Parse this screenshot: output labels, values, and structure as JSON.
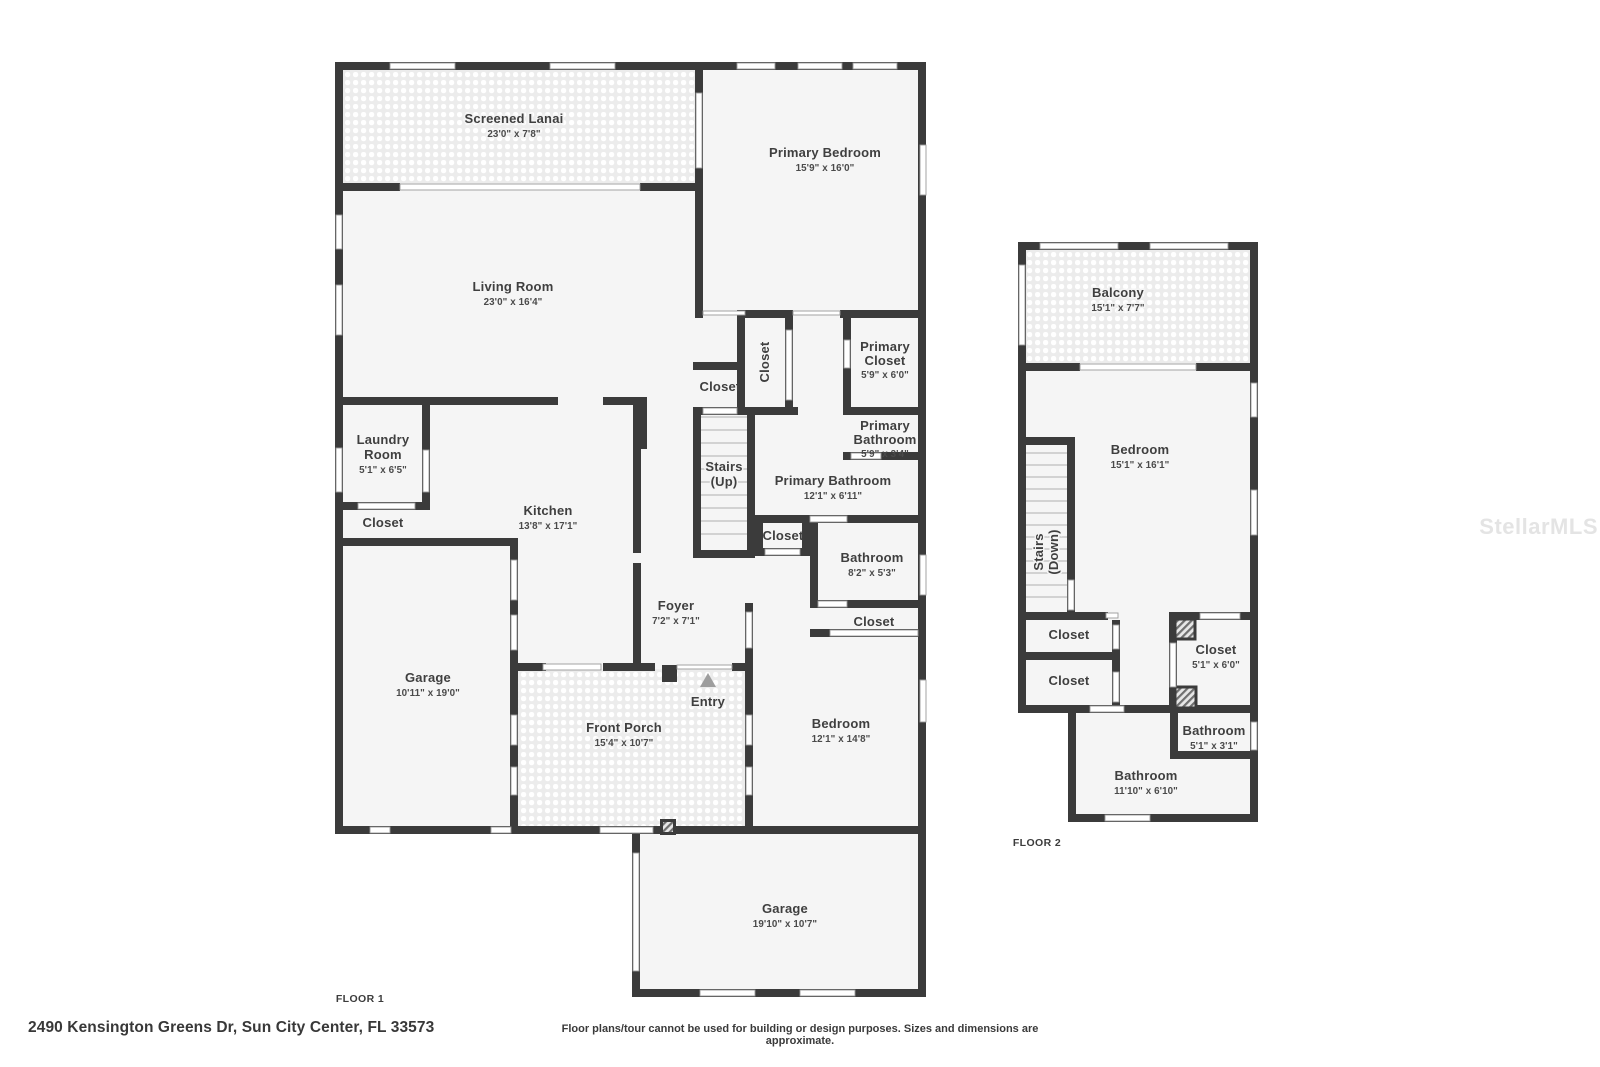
{
  "floor1": {
    "label": "FLOOR 1",
    "lanai": {
      "name": "Screened Lanai",
      "dims": "23'0\" x 7'8\""
    },
    "primary_bedroom": {
      "name": "Primary Bedroom",
      "dims": "15'9\" x 16'0\""
    },
    "living_room": {
      "name": "Living Room",
      "dims": "23'0\" x 16'4\""
    },
    "closet_vertical": {
      "name": "Closet"
    },
    "closet_hall": {
      "name": "Closet"
    },
    "primary_closet": {
      "line1": "Primary",
      "line2": "Closet",
      "dims": "5'9\" x 6'0\""
    },
    "primary_bathroom_small": {
      "line1": "Primary",
      "line2": "Bathroom",
      "dims": "5'9\" x 3'4\""
    },
    "stairs": {
      "line1": "Stairs",
      "line2": "(Up)"
    },
    "primary_bathroom": {
      "name": "Primary Bathroom",
      "dims": "12'1\" x 6'11\""
    },
    "laundry": {
      "line1": "Laundry",
      "line2": "Room",
      "dims": "5'1\" x 6'5\""
    },
    "closet_laundry": {
      "name": "Closet"
    },
    "kitchen": {
      "name": "Kitchen",
      "dims": "13'8\" x 17'1\""
    },
    "closet_stairwell": {
      "name": "Closet"
    },
    "bathroom": {
      "name": "Bathroom",
      "dims": "8'2\" x 5'3\""
    },
    "closet_bedroom": {
      "name": "Closet"
    },
    "foyer": {
      "name": "Foyer",
      "dims": "7'2\" x 7'1\""
    },
    "garage_side": {
      "name": "Garage",
      "dims": "10'11\" x 19'0\""
    },
    "entry": {
      "name": "Entry"
    },
    "front_porch": {
      "name": "Front Porch",
      "dims": "15'4\" x 10'7\""
    },
    "bedroom": {
      "name": "Bedroom",
      "dims": "12'1\" x 14'8\""
    },
    "garage_bottom": {
      "name": "Garage",
      "dims": "19'10\" x 10'7\""
    }
  },
  "floor2": {
    "label": "FLOOR 2",
    "balcony": {
      "name": "Balcony",
      "dims": "15'1\" x 7'7\""
    },
    "bedroom": {
      "name": "Bedroom",
      "dims": "15'1\" x 16'1\""
    },
    "stairs": {
      "line1": "Stairs",
      "line2": "(Down)"
    },
    "closet_a": {
      "name": "Closet"
    },
    "closet_b": {
      "name": "Closet"
    },
    "closet_main": {
      "name": "Closet",
      "dims": "5'1\" x 6'0\""
    },
    "bathroom_small": {
      "name": "Bathroom",
      "dims": "5'1\" x 3'1\""
    },
    "bathroom_main": {
      "name": "Bathroom",
      "dims": "11'10\" x 6'10\""
    }
  },
  "footer": {
    "address": "2490 Kensington Greens Dr, Sun City Center, FL 33573",
    "disclaimer": "Floor plans/tour cannot be used for building or design purposes. Sizes and dimensions are approximate."
  },
  "watermark": "StellarMLS",
  "colors": {
    "wall": "#3b3b3b",
    "room_fill": "#f5f5f5",
    "pattern_fill": "#ededed",
    "room_text": "#3f3f3f",
    "entry_arrow": "#9e9e9e",
    "watermark_text": "#e4e4e4"
  }
}
